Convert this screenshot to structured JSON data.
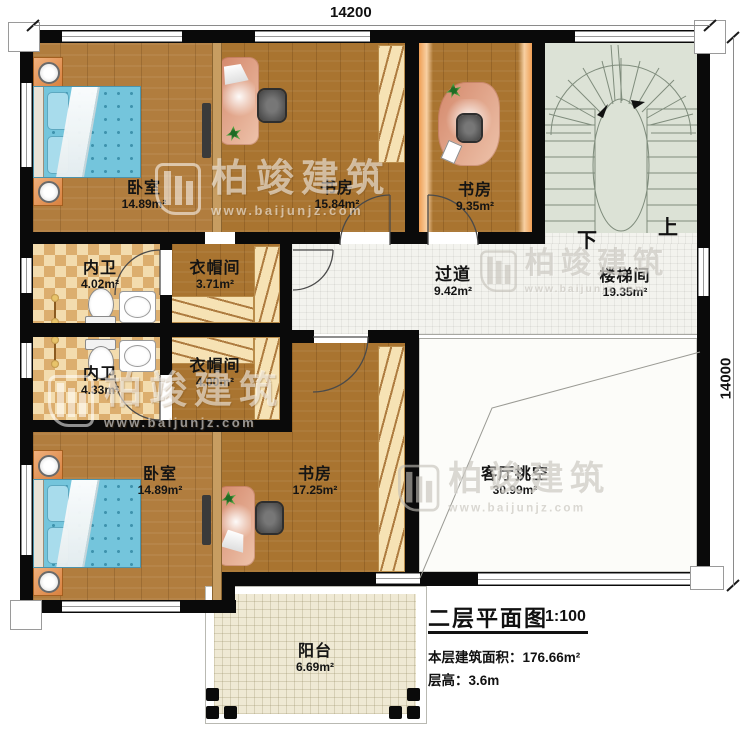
{
  "plan": {
    "dimensions": {
      "top": "14200",
      "right": "14000"
    },
    "rooms": [
      {
        "id": "bedroom-top",
        "name": "卧室",
        "area": "14.89m²"
      },
      {
        "id": "study-top",
        "name": "书房",
        "area": "15.84m²"
      },
      {
        "id": "study-small",
        "name": "书房",
        "area": "9.35m²"
      },
      {
        "id": "bath-upper",
        "name": "内卫",
        "area": "4.02m²"
      },
      {
        "id": "closet-upper",
        "name": "衣帽间",
        "area": "3.71m²"
      },
      {
        "id": "hallway",
        "name": "过道",
        "area": "9.42m²"
      },
      {
        "id": "stairwell",
        "name": "楼梯间",
        "area": "19.35m²"
      },
      {
        "id": "bath-lower",
        "name": "内卫",
        "area": "4.33m²"
      },
      {
        "id": "closet-lower",
        "name": "衣帽间",
        "area": "4.00m²"
      },
      {
        "id": "bedroom-bottom",
        "name": "卧室",
        "area": "14.89m²"
      },
      {
        "id": "study-large",
        "name": "书房",
        "area": "17.25m²"
      },
      {
        "id": "living-void",
        "name": "客厅挑空",
        "area": "30.99m²"
      },
      {
        "id": "balcony",
        "name": "阳台",
        "area": "6.69m²"
      }
    ],
    "stairs": {
      "down": "下",
      "up": "上"
    },
    "watermark": {
      "name": "柏竣建筑",
      "url": "www.baijunjz.com"
    },
    "titleblock": {
      "title": "二层平面图",
      "scale": "1:100",
      "area_label": "本层建筑面积：",
      "area_value": "176.66m²",
      "floor_height_label": "层高：",
      "floor_height_value": "3.6m"
    },
    "colors": {
      "wall": "#0a0a0a",
      "wood_floor": "#ad7734",
      "bath_tile": "#e8c98e",
      "hall_tile": "#f3f3ee",
      "stair_floor": "#dce2d6",
      "desk": "#d4886b",
      "bed": "#74c5dc",
      "balcony_floor": "#efe9d4"
    }
  }
}
